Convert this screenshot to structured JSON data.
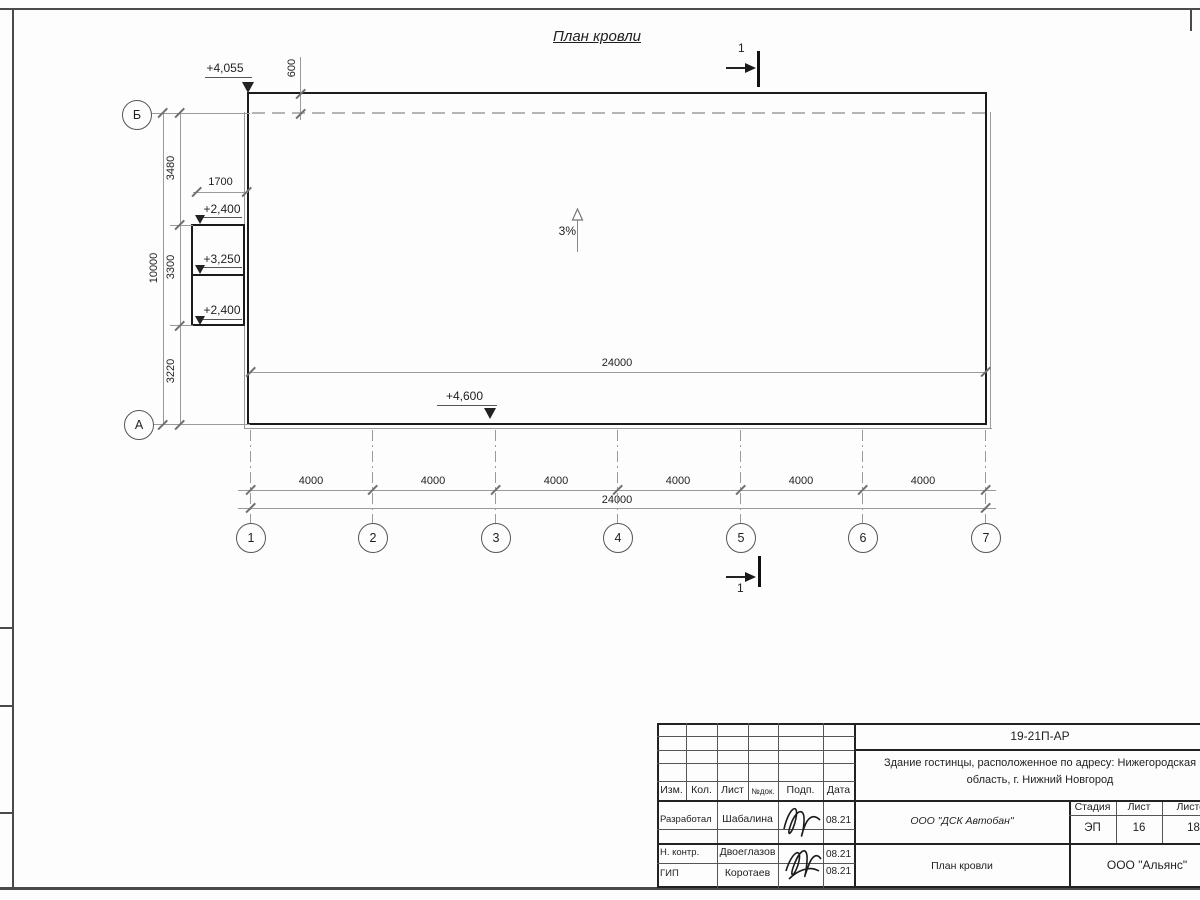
{
  "drawing": {
    "title": "План кровли",
    "slope_label": "3%",
    "section": {
      "top": "1",
      "bottom": "1"
    },
    "elevations": {
      "roof_main": "+4,055",
      "canopy_upper": "+2,400",
      "canopy_mid": "+3,250",
      "canopy_lower": "+2,400",
      "roof_bottom": "+4,600"
    },
    "dimensions": {
      "parapet_offset": "600",
      "canopy_width": "1700",
      "left_segment_top": "3480",
      "left_segment_mid": "3300",
      "left_segment_bottom": "3220",
      "left_total": "10000",
      "inner_total": "24000",
      "bottom_total": "24000",
      "bays": [
        "4000",
        "4000",
        "4000",
        "4000",
        "4000",
        "4000"
      ]
    },
    "axes": {
      "horizontal": [
        "1",
        "2",
        "3",
        "4",
        "5",
        "6",
        "7"
      ],
      "vertical": [
        "Б",
        "А"
      ]
    }
  },
  "titleblock": {
    "doc_number": "19-21П-АР",
    "project_name_line1": "Здание гостинцы, расположенное по адресу: Нижегородская",
    "project_name_line2": "область, г. Нижний Новгород",
    "revision_header": [
      "Изм.",
      "Кол.",
      "Лист",
      "№док.",
      "Подп.",
      "Дата"
    ],
    "stage_header": [
      "Стадия",
      "Лист",
      "Листов"
    ],
    "stage_values": [
      "ЭП",
      "16",
      "18"
    ],
    "contractor": "ООО \"ДСК Автобан\"",
    "sheet_title": "План кровли",
    "company": "ООО \"Альянс\"",
    "people": [
      {
        "role": "Разработал",
        "name": "Шабалина",
        "date": "08.21"
      },
      {
        "role": "Н. контр.",
        "name": "Двоеглазов",
        "date": "08.21"
      },
      {
        "role": "ГИП",
        "name": "Коротаев",
        "date": "08.21"
      }
    ]
  }
}
